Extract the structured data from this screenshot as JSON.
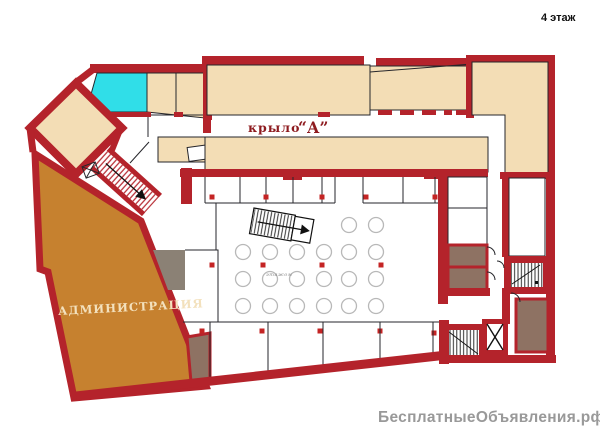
{
  "labels": {
    "floor": "4 этаж",
    "wing_word": "крыло",
    "wing_letter": "“А”",
    "admin": "АДМИНИСТРАЦИЯ",
    "center_note": "этажом",
    "watermark": "БесплатныеОбъявления.рф"
  },
  "colors": {
    "wall": "#b4232b",
    "room": "#f3ddb5",
    "cyan": "#30dee8",
    "admin": "#c6812f",
    "gray": "#8b8175",
    "gray2": "#8e7263",
    "column": "#c42424",
    "table_stroke": "#b8b8b8",
    "text_dark_red": "#8e1b1f",
    "admin_text": "#f3e1bd",
    "watermark": "#999999",
    "floor_label": "#111111",
    "note_text": "#8a8a8a"
  },
  "plan": {
    "tables": [
      [
        243,
        252
      ],
      [
        270,
        252
      ],
      [
        297,
        252
      ],
      [
        324,
        252
      ],
      [
        243,
        279
      ],
      [
        270,
        279
      ],
      [
        297,
        279
      ],
      [
        324,
        279
      ],
      [
        243,
        306
      ],
      [
        270,
        306
      ],
      [
        297,
        306
      ],
      [
        324,
        306
      ],
      [
        349,
        225
      ],
      [
        376,
        225
      ],
      [
        349,
        252
      ],
      [
        376,
        252
      ],
      [
        349,
        279
      ],
      [
        376,
        279
      ],
      [
        349,
        306
      ],
      [
        376,
        306
      ]
    ],
    "columns": [
      [
        212,
        197
      ],
      [
        266,
        197
      ],
      [
        322,
        197
      ],
      [
        366,
        197
      ],
      [
        435,
        197
      ],
      [
        212,
        265
      ],
      [
        263,
        265
      ],
      [
        322,
        265
      ],
      [
        381,
        265
      ],
      [
        202,
        331
      ],
      [
        262,
        331
      ],
      [
        320,
        331
      ],
      [
        380,
        331
      ],
      [
        434,
        333
      ]
    ]
  }
}
